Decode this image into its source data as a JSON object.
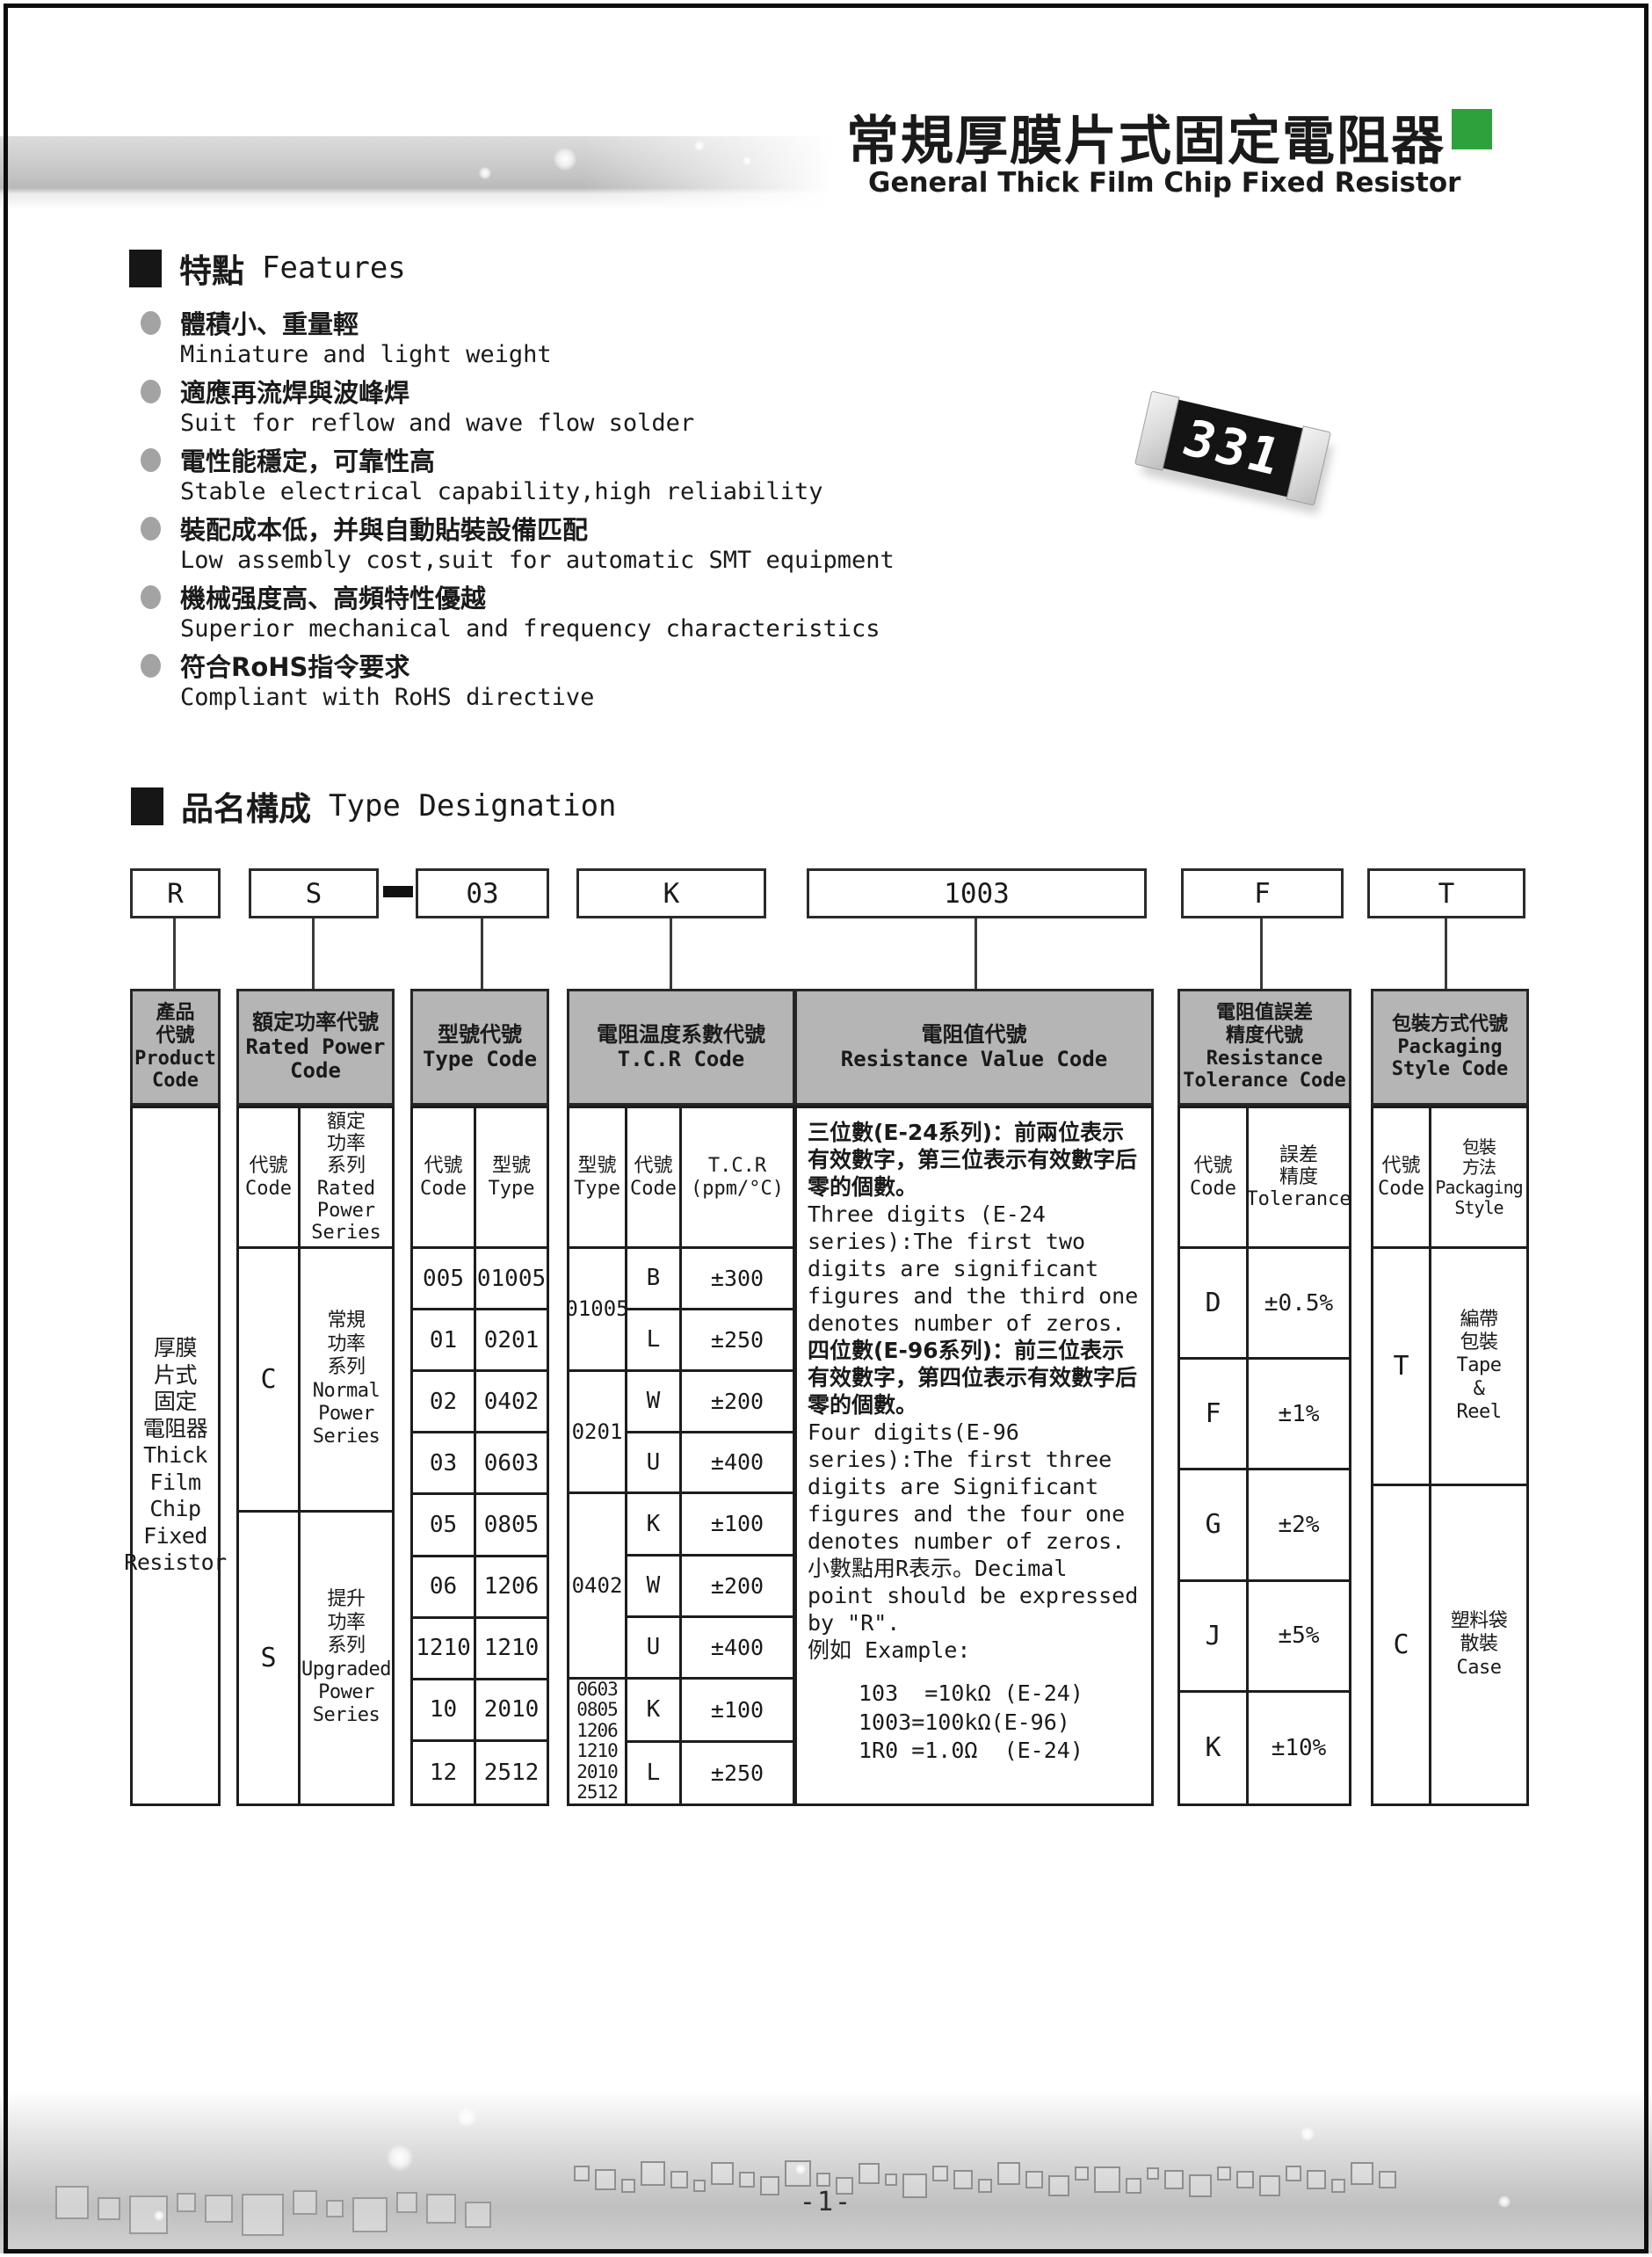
{
  "page": {
    "title_zh": "常規厚膜片式固定電阻器",
    "title_en": "General Thick Film Chip Fixed Resistor",
    "page_number": "-1-"
  },
  "resistor_chip": {
    "marking": "331"
  },
  "features": {
    "heading_zh": "特點",
    "heading_en": "Features",
    "items": [
      {
        "zh": "體積小、重量輕",
        "en": "Miniature and light weight"
      },
      {
        "zh": "適應再流焊與波峰焊",
        "en": "Suit for reflow and wave flow solder"
      },
      {
        "zh": "電性能穩定，可靠性高",
        "en": "Stable electrical capability,high reliability"
      },
      {
        "zh": "裝配成本低，并與自動貼裝設備匹配",
        "en": "Low assembly cost,suit for automatic SMT equipment"
      },
      {
        "zh": "機械强度高、高頻特性優越",
        "en": "Superior mechanical and frequency characteristics"
      },
      {
        "zh": "符合RoHS指令要求",
        "en": "Compliant with RoHS directive"
      }
    ]
  },
  "type_designation": {
    "heading_zh": "品名構成",
    "heading_en": "Type Designation",
    "code_boxes": [
      "R",
      "S",
      "03",
      "K",
      "1003",
      "F",
      "T"
    ],
    "columns": {
      "product": {
        "header": "產品\n代號\nProduct\nCode",
        "body": "厚膜\n片式\n固定\n電阻器\nThick\nFilm\nChip\nFixed\nResistor"
      },
      "power": {
        "header": "額定功率代號\nRated Power\nCode",
        "sub_code": "代號\nCode",
        "sub_series": "額定\n功率\n系列\nRated\nPower\nSeries",
        "rows": [
          {
            "code": "C",
            "series": "常規\n功率\n系列\nNormal\nPower\nSeries"
          },
          {
            "code": "S",
            "series": "提升\n功率\n系列\nUpgraded\nPower\nSeries"
          }
        ]
      },
      "type": {
        "header": "型號代號\nType Code",
        "sub_code": "代號\nCode",
        "sub_type": "型號\nType",
        "rows": [
          [
            "005",
            "01005"
          ],
          [
            "01",
            "0201"
          ],
          [
            "02",
            "0402"
          ],
          [
            "03",
            "0603"
          ],
          [
            "05",
            "0805"
          ],
          [
            "06",
            "1206"
          ],
          [
            "1210",
            "1210"
          ],
          [
            "10",
            "2010"
          ],
          [
            "12",
            "2512"
          ]
        ]
      },
      "tcr": {
        "header": "電阻温度系數代號\nT.C.R Code",
        "sub_type": "型號\nType",
        "sub_code": "代號\nCode",
        "sub_value": "T.C.R\n(ppm/°C)",
        "groups": [
          {
            "type": "01005",
            "entries": [
              [
                "B",
                "±300"
              ],
              [
                "L",
                "±250"
              ]
            ]
          },
          {
            "type": "0201",
            "entries": [
              [
                "W",
                "±200"
              ],
              [
                "U",
                "±400"
              ]
            ]
          },
          {
            "type": "0402",
            "entries": [
              [
                "K",
                "±100"
              ],
              [
                "W",
                "±200"
              ],
              [
                "U",
                "±400"
              ]
            ]
          },
          {
            "type": "0603\n0805\n1206\n1210\n2010\n2512",
            "entries": [
              [
                "K",
                "±100"
              ],
              [
                "L",
                "±250"
              ]
            ]
          }
        ]
      },
      "value": {
        "header": "電阻值代號\nResistance Value Code",
        "paragraphs": [
          "三位數(E-24系列)：前兩位表示有效數字，第三位表示有效數字后零的個數。",
          "Three digits (E-24 series):The first two digits are significant figures and the third one denotes number of zeros.",
          "四位數(E-96系列)：前三位表示有效數字，第四位表示有效數字后零的個數。",
          "Four digits(E-96 series):The first three digits are Significant figures and the four one denotes number of zeros.",
          "小數點用R表示。Decimal point should be expressed by \"R\".",
          "例如 Example:"
        ],
        "examples": [
          "103  =10kΩ (E-24)",
          "1003=100kΩ(E-96)",
          "1R0 =1.0Ω  (E-24)"
        ]
      },
      "tolerance": {
        "header": "電阻值誤差\n精度代號\nResistance\nTolerance Code",
        "sub_code": "代號\nCode",
        "sub_tol": "誤差\n精度\nTolerance",
        "rows": [
          [
            "D",
            "±0.5%"
          ],
          [
            "F",
            "±1%"
          ],
          [
            "G",
            "±2%"
          ],
          [
            "J",
            "±5%"
          ],
          [
            "K",
            "±10%"
          ]
        ]
      },
      "packaging": {
        "header": "包裝方式代號\nPackaging\nStyle Code",
        "sub_code": "代號\nCode",
        "sub_style": "包裝\n方法\nPackaging\nStyle",
        "rows": [
          {
            "code": "T",
            "style": "編帶\n包裝\nTape\n&\nReel"
          },
          {
            "code": "C",
            "style": "塑料袋\n散裝\nCase"
          }
        ]
      }
    }
  }
}
